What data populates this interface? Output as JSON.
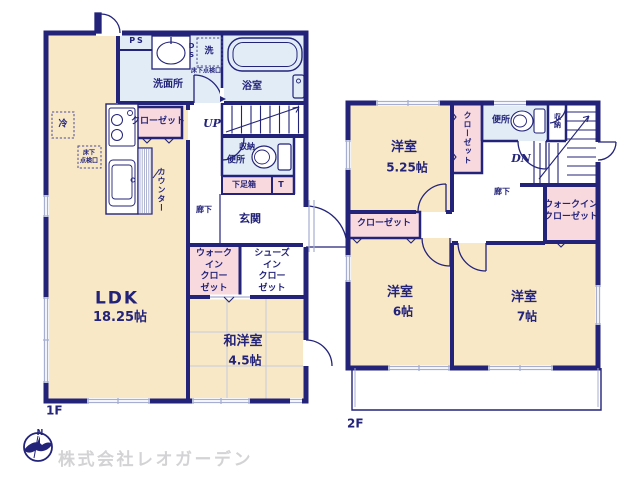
{
  "colors": {
    "wall": "#23237a",
    "room_beige": "#f8e8c5",
    "closet_pink": "#f8d9de",
    "wet_blue": "#e1ecf7",
    "window_glyph": "#a6aed2",
    "watermark": "#d3d3d5"
  },
  "floor1": {
    "floor_label": "1F",
    "labels": {
      "ps": "PS",
      "ds": "DS",
      "sen": "洗",
      "senmenjo": "洗面所",
      "yokushitsu": "浴室",
      "tenkenko": "床下点検口",
      "tenkenko_2line": "床下\n点検口",
      "rei": "冷",
      "closet": "クローゼット",
      "up": "UP",
      "counter": "カウンター",
      "shuno": "収納",
      "benjo": "便所",
      "getabako": "下足箱",
      "t": "T",
      "roka": "廊下",
      "genkan": "玄関",
      "wic": "ウォーク\nイン\nクロー\nゼット",
      "sic": "シューズ\nイン\nクロー\nゼット",
      "ldk_name": "LDK",
      "ldk_size": "18.25帖",
      "wayou_name": "和洋室",
      "wayou_size": "4.5帖"
    }
  },
  "floor2": {
    "floor_label": "2F",
    "labels": {
      "yoshitsu1_name": "洋室",
      "yoshitsu1_size": "5.25帖",
      "closet_v": "クローゼット",
      "benjo": "便所",
      "shuno": "収納",
      "dn": "DN",
      "roka": "廊下",
      "wic": "ウォークイン\nクローゼット",
      "closet_h": "クローゼット",
      "yoshitsu2_name": "洋室",
      "yoshitsu2_size": "6帖",
      "yoshitsu3_name": "洋室",
      "yoshitsu3_size": "7帖"
    }
  },
  "footer": {
    "company": "株式会社レオガーデン",
    "compass_n": "N"
  }
}
